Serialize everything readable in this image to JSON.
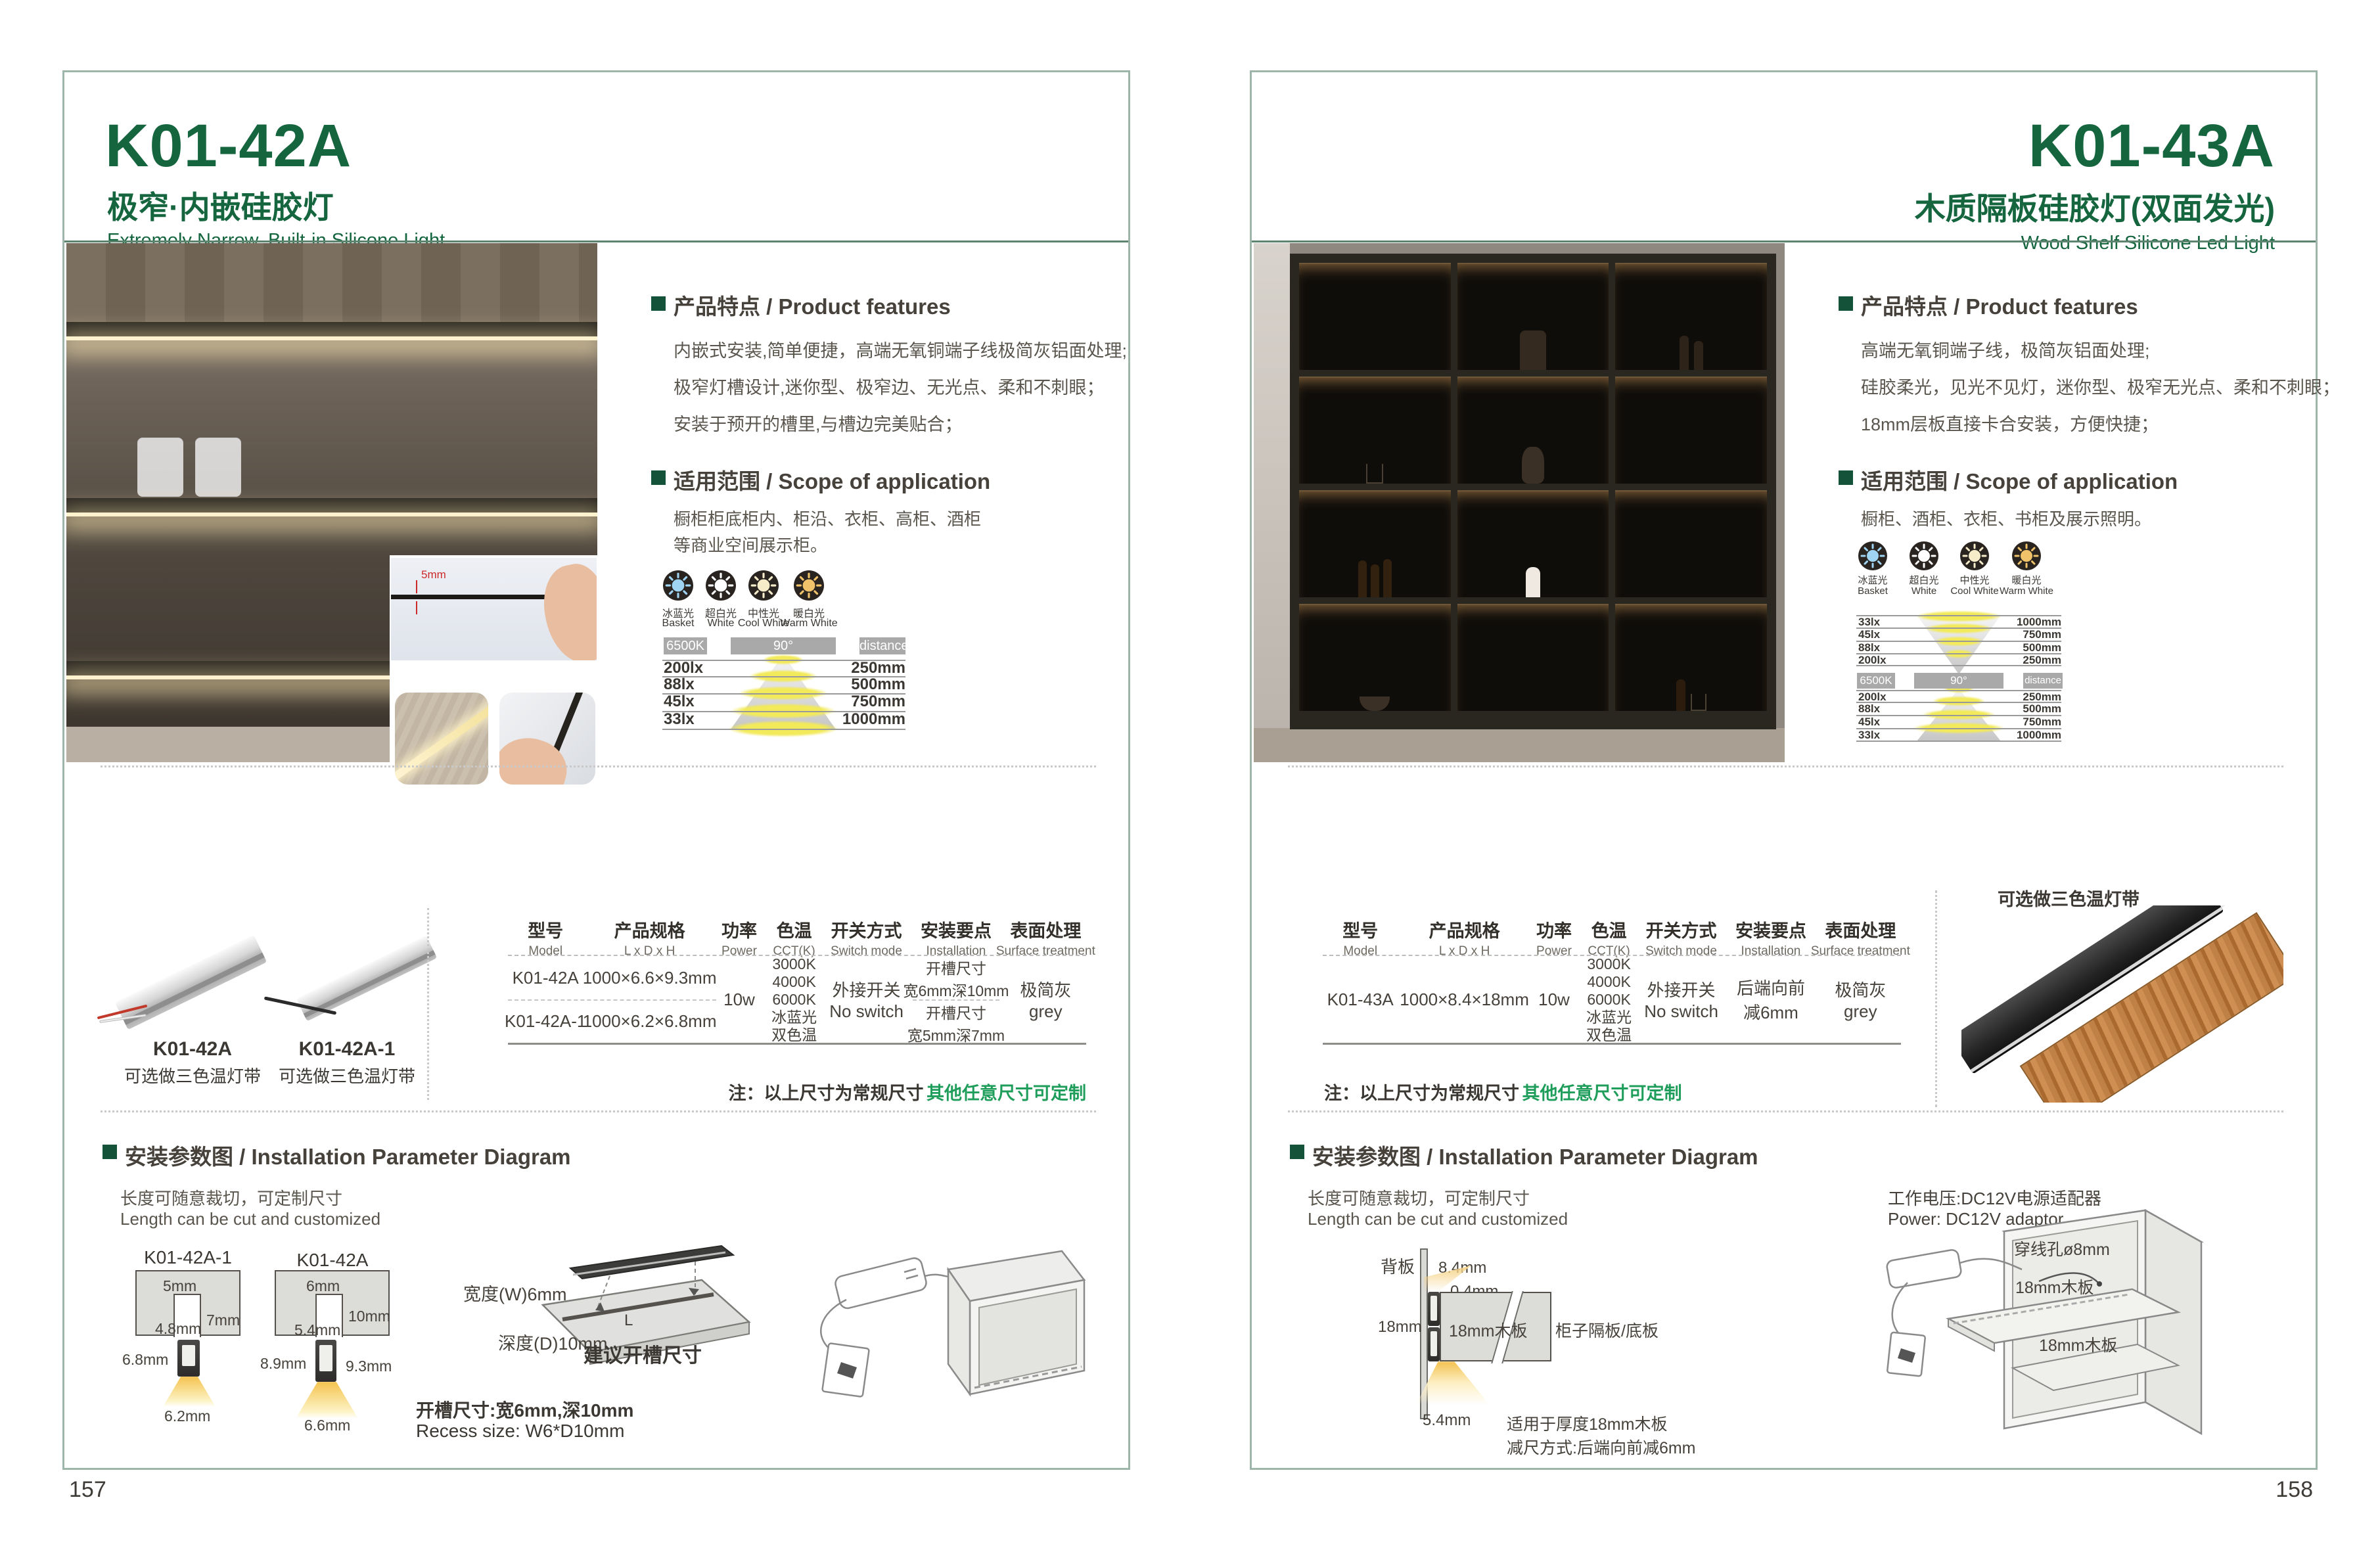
{
  "left": {
    "model": "K01-42A",
    "title_cn": "极窄·内嵌硅胶灯",
    "title_en": "Extremely Narrow. Built-in Silicone Light",
    "page_number": "157",
    "features_heading": "产品特点 / Product features",
    "features": [
      "内嵌式安装,简单便捷，高端无氧铜端子线极简灰铝面处理;",
      "极窄灯槽设计,迷你型、极窄边、无光点、柔和不刺眼；",
      "安装于预开的槽里,与槽边完美贴合；"
    ],
    "scope_heading": "适用范围 / Scope of application",
    "scope": [
      "橱柜柜底柜内、柜沿、衣柜、高柜、酒柜",
      "等商业空间展示柜。"
    ],
    "photo_dim": "5mm",
    "photometry": {
      "icons": [
        {
          "cn": "冰蓝光",
          "en": "Basket",
          "color": "#9fd4f2"
        },
        {
          "cn": "超白光",
          "en": "White",
          "color": "#ffffff"
        },
        {
          "cn": "中性光",
          "en": "Cool White",
          "color": "#f6ecca"
        },
        {
          "cn": "暖白光",
          "en": "Warm White",
          "color": "#f0c36a"
        }
      ],
      "cct": "6500K",
      "angle": "90°",
      "distance": "distance",
      "rows": [
        {
          "lux": "200lx",
          "mm": "250mm"
        },
        {
          "lux": "88lx",
          "mm": "500mm"
        },
        {
          "lux": "45lx",
          "mm": "750mm"
        },
        {
          "lux": "33lx",
          "mm": "1000mm"
        }
      ]
    },
    "products": [
      {
        "name": "K01-42A",
        "caption": "可选做三色温灯带"
      },
      {
        "name": "K01-42A-1",
        "caption": "可选做三色温灯带"
      }
    ],
    "table": {
      "headers": [
        {
          "cn": "型号",
          "en": "Model"
        },
        {
          "cn": "产品规格",
          "en": "L x D x H"
        },
        {
          "cn": "功率",
          "en": "Power"
        },
        {
          "cn": "色温",
          "en": "CCT(K)"
        },
        {
          "cn": "开关方式",
          "en": "Switch mode"
        },
        {
          "cn": "安装要点",
          "en": "Installation"
        },
        {
          "cn": "表面处理",
          "en": "Surface treatment"
        }
      ],
      "rows": [
        {
          "model": "K01-42A",
          "size": "1000×6.6×9.3mm",
          "install1": "开槽尺寸",
          "install2": "宽6mm深10mm"
        },
        {
          "model": "K01-42A-1",
          "size": "1000×6.2×6.8mm",
          "install1": "开槽尺寸",
          "install2": "宽5mm深7mm"
        }
      ],
      "power": "10w",
      "cct": [
        "3000K",
        "4000K",
        "6000K",
        "冰蓝光",
        "双色温"
      ],
      "switch1": "外接开关",
      "switch2": "No switch",
      "surface1": "极简灰",
      "surface2": "grey"
    },
    "note1": "注：以上尺寸为常规尺寸",
    "note2": "其他任意尺寸可定制",
    "install_heading": "安装参数图 / Installation Parameter Diagram",
    "length_cn": "长度可随意裁切，可定制尺寸",
    "length_en": "Length can be cut and customized",
    "diagramA": {
      "label": "K01-42A-1",
      "top": "5mm",
      "depth": "7mm",
      "inner": "4.8mm",
      "height": "6.8mm",
      "bottom": "6.2mm"
    },
    "diagramB": {
      "label": "K01-42A",
      "top": "6mm",
      "depth": "10mm",
      "inner": "5.4mm",
      "height": "8.9mm",
      "height2": "9.3mm",
      "bottom": "6.6mm"
    },
    "recess": {
      "w": "宽度(W)6mm",
      "d": "深度(D)10mm",
      "l": "L",
      "caption": "建议开槽尺寸",
      "size_cn": "开槽尺寸:宽6mm,深10mm",
      "size_en": "Recess size: W6*D10mm"
    }
  },
  "right": {
    "model": "K01-43A",
    "title_cn": "木质隔板硅胶灯(双面发光)",
    "title_en": "Wood Shelf Silicone Led Light",
    "page_number": "158",
    "features_heading": "产品特点 / Product features",
    "features": [
      "高端无氧铜端子线，极简灰铝面处理;",
      "硅胶柔光，见光不见灯，迷你型、极窄无光点、柔和不刺眼；",
      "18mm层板直接卡合安装，方便快捷；"
    ],
    "scope_heading": "适用范围 / Scope of application",
    "scope": [
      "橱柜、酒柜、衣柜、书柜及展示照明。"
    ],
    "photometry": {
      "icons": [
        {
          "cn": "冰蓝光",
          "en": "Basket",
          "color": "#9fd4f2"
        },
        {
          "cn": "超白光",
          "en": "White",
          "color": "#ffffff"
        },
        {
          "cn": "中性光",
          "en": "Cool White",
          "color": "#f6ecca"
        },
        {
          "cn": "暖白光",
          "en": "Warm White",
          "color": "#f0c36a"
        }
      ],
      "cct": "6500K",
      "angle": "90°",
      "distance": "distance",
      "rows_top": [
        {
          "lux": "33lx",
          "mm": "1000mm"
        },
        {
          "lux": "45lx",
          "mm": "750mm"
        },
        {
          "lux": "88lx",
          "mm": "500mm"
        },
        {
          "lux": "200lx",
          "mm": "250mm"
        }
      ],
      "rows_bottom": [
        {
          "lux": "200lx",
          "mm": "250mm"
        },
        {
          "lux": "88lx",
          "mm": "500mm"
        },
        {
          "lux": "45lx",
          "mm": "750mm"
        },
        {
          "lux": "33lx",
          "mm": "1000mm"
        }
      ]
    },
    "product_caption": "可选做三色温灯带",
    "table": {
      "headers": [
        {
          "cn": "型号",
          "en": "Model"
        },
        {
          "cn": "产品规格",
          "en": "L x D x H"
        },
        {
          "cn": "功率",
          "en": "Power"
        },
        {
          "cn": "色温",
          "en": "CCT(K)"
        },
        {
          "cn": "开关方式",
          "en": "Switch mode"
        },
        {
          "cn": "安装要点",
          "en": "Installation"
        },
        {
          "cn": "表面处理",
          "en": "Surface treatment"
        }
      ],
      "row": {
        "model": "K01-43A",
        "size": "1000×8.4×18mm",
        "power": "10w",
        "install1": "后端向前",
        "install2": "减6mm",
        "switch1": "外接开关",
        "switch2": "No switch",
        "surface1": "极简灰",
        "surface2": "grey"
      },
      "cct": [
        "3000K",
        "4000K",
        "6000K",
        "冰蓝光",
        "双色温"
      ]
    },
    "note1": "注：以上尺寸为常规尺寸",
    "note2": "其他任意尺寸可定制",
    "install_heading": "安装参数图 / Installation Parameter Diagram",
    "length_cn": "长度可随意裁切，可定制尺寸",
    "length_en": "Length can be cut and customized",
    "diagram": {
      "back": "背板",
      "d1": "8.4mm",
      "d2": "0.4mm",
      "d3": "18mm",
      "board": "18mm木板",
      "panel": "柜子隔板/底板",
      "d4": "5.4mm",
      "note1": "适用于厚度18mm木板",
      "note2": "减尺方式:后端向前减6mm"
    },
    "adapter_cn": "工作电压:DC12V电源适配器",
    "adapter_en": "Power: DC12V adaptor",
    "hole": "穿线孔ø8mm",
    "shelf1": "18mm木板",
    "shelf2": "18mm木板"
  }
}
